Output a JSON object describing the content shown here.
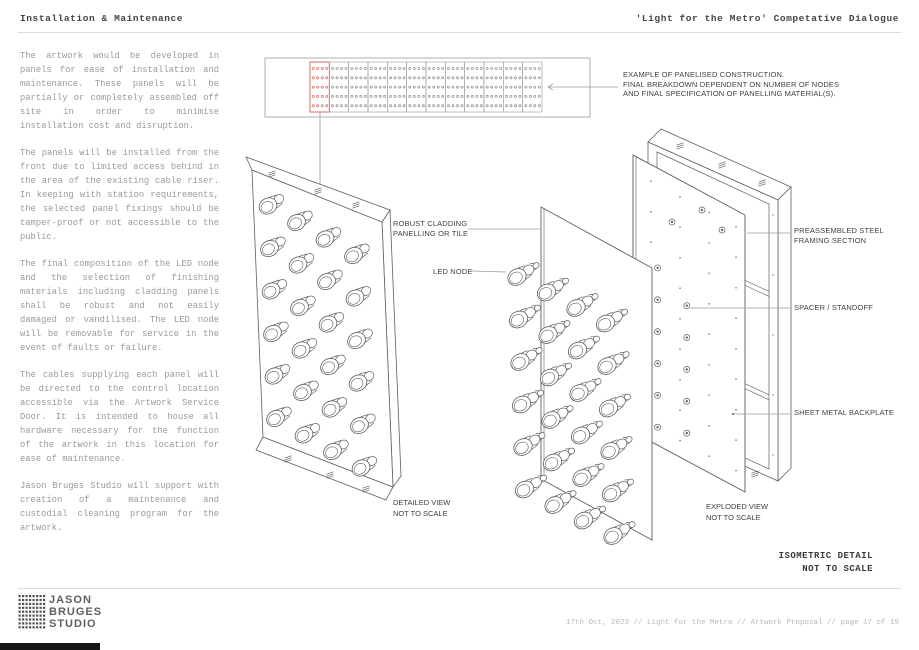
{
  "header": {
    "left_title": "Installation & Maintenance",
    "right_title": "'Light for the Metro' Competative Dialogue"
  },
  "body": {
    "paragraphs": [
      "The artwork would be developed in panels for ease of installation and maintenance. These panels will be partially or completely assembled off site in order to minimise installation cost and disruption.",
      "The panels will be installed from the front due to limited access behind in the area of the existing cable riser. In keeping with station requirements, the selected panel fixings should be tamper-proof or not accessible to the public.",
      "The final composition of the LED node and the selection of finishing materials including cladding panels shall be robust and not easily damaged or vandilised. The LED node will be removable for service in the event of faults or failure.",
      "The cables supplying each panel will be directed to the control location accessible via the Artwork Service Door. It is intended to house all hardware necessary for the function of the artwork in this location for ease of maintenance.",
      "Jason Bruges Studio will support with creation of a maintenance and custodial cleaning program for the artwork."
    ]
  },
  "diagram": {
    "annotations": {
      "panelised_line1": "EXAMPLE OF PANELISED CONSTRUCTION.",
      "panelised_line2": "FINAL BREAKDOWN DEPENDENT ON NUMBER OF NODES",
      "panelised_line3": "AND FINAL SPECIFICATION OF PANELLING MATERIAL(S).",
      "cladding_line1": "ROBUST CLADDING",
      "cladding_line2": "PANELLING OR TILE",
      "led_node": "LED NODE",
      "framing_line1": "PREASSEMBLED STEEL",
      "framing_line2": "FRAMING SECTION",
      "spacer": "SPACER / STANDOFF",
      "backplate": "SHEET METAL BACKPLATE"
    },
    "captions": {
      "detailed_line1": "DETAILED VIEW",
      "detailed_line2": "NOT TO SCALE",
      "exploded_line1": "EXPLODED VIEW",
      "exploded_line2": "NOT TO SCALE",
      "isometric_line1": "ISOMETRIC DETAIL",
      "isometric_line2": "NOT TO SCALE"
    }
  },
  "footer": {
    "logo": {
      "lines": [
        "JASON",
        "BRUGES",
        "STUDIO"
      ]
    },
    "meta": "17th Oct, 2023 // Light for the Metro // Artwork Proposal // page 17 of 19"
  },
  "colors": {
    "accent_red": "#d9685f",
    "line_dark": "#5f5f5f",
    "line_light": "#9a9a9a",
    "dot_gray": "#8f8f8f",
    "text_gray": "#9a9a9a",
    "text_dark": "#3f3f3f"
  }
}
